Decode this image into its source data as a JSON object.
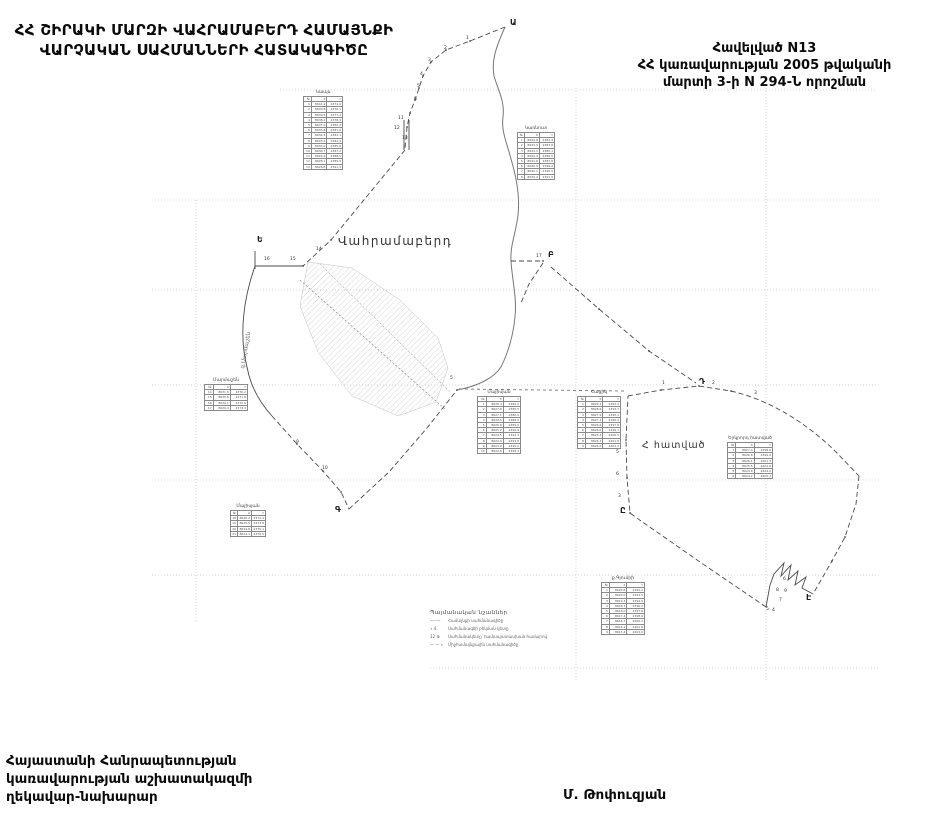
{
  "header": {
    "title_line1": "ՀՀ ՇԻՐԱԿԻ ՄԱՐԶԻ ՎԱՀՐԱՄԱԲԵՐԴ ՀԱՄԱՅՆՔԻ",
    "title_line2": "ՎԱՐՉԱԿԱՆ ՍԱՀՄԱՆՆԵՐԻ ՀԱՏԱԿԱԳԻԾԸ"
  },
  "appendix": {
    "line1": "Հավելված  N13",
    "line2": "ՀՀ կառավարության 2005 թվականի",
    "line3": "մարտի 3-ի N 294-Ն որոշման"
  },
  "footer": {
    "left_line1": "Հայաստանի Հանրապետության",
    "left_line2": "կառավարության աշխատակազմի",
    "left_line3": "ղեկավար-նախարար",
    "signature": "Մ. Թոփուզյան"
  },
  "map": {
    "settlement_label": "Վահրամաբերդ",
    "section_label": "Հ հատված",
    "west_label": "գ.Մարմաշեն",
    "colors": {
      "boundary": "#4a4a4a",
      "river": "#777777",
      "grid": "#cccccc",
      "hatch": "#b5b5b5"
    },
    "letters": [
      {
        "t": "Ա",
        "x": 510,
        "y": 18
      },
      {
        "t": "Բ",
        "x": 548,
        "y": 250
      },
      {
        "t": "Գ",
        "x": 335,
        "y": 505
      },
      {
        "t": "Դ",
        "x": 699,
        "y": 377
      },
      {
        "t": "Ե",
        "x": 257,
        "y": 235
      },
      {
        "t": "Ը",
        "x": 620,
        "y": 506
      },
      {
        "t": "Է",
        "x": 806,
        "y": 593
      }
    ],
    "points": [
      {
        "t": "1",
        "x": 466,
        "y": 36
      },
      {
        "t": "2",
        "x": 444,
        "y": 46
      },
      {
        "t": "3",
        "x": 428,
        "y": 58
      },
      {
        "t": "4",
        "x": 420,
        "y": 72
      },
      {
        "t": "5",
        "x": 417,
        "y": 84
      },
      {
        "t": "6",
        "x": 414,
        "y": 97
      },
      {
        "t": "11",
        "x": 398,
        "y": 116
      },
      {
        "t": "12",
        "x": 394,
        "y": 126
      },
      {
        "t": "13",
        "x": 402,
        "y": 136
      },
      {
        "t": "14",
        "x": 316,
        "y": 247
      },
      {
        "t": "15",
        "x": 290,
        "y": 257
      },
      {
        "t": "16",
        "x": 264,
        "y": 257
      },
      {
        "t": "17",
        "x": 536,
        "y": 254
      },
      {
        "t": "9",
        "x": 296,
        "y": 440
      },
      {
        "t": "10",
        "x": 322,
        "y": 466
      },
      {
        "t": "5",
        "x": 450,
        "y": 376
      },
      {
        "t": "1",
        "x": 662,
        "y": 381
      },
      {
        "t": "2",
        "x": 712,
        "y": 381
      },
      {
        "t": "3",
        "x": 754,
        "y": 391
      },
      {
        "t": "4",
        "x": 616,
        "y": 430
      },
      {
        "t": "5",
        "x": 616,
        "y": 450
      },
      {
        "t": "6",
        "x": 616,
        "y": 472
      },
      {
        "t": "3",
        "x": 618,
        "y": 494
      },
      {
        "t": "6",
        "x": 783,
        "y": 577
      },
      {
        "t": "8",
        "x": 776,
        "y": 588
      },
      {
        "t": "9",
        "x": 784,
        "y": 589
      },
      {
        "t": "7",
        "x": 779,
        "y": 598
      },
      {
        "t": "4",
        "x": 772,
        "y": 608
      },
      {
        "t": "5",
        "x": 766,
        "y": 607
      }
    ],
    "table_header": [
      "№",
      "X",
      "Y"
    ],
    "tables": [
      {
        "title": "Կապս",
        "x": 303,
        "y": 90,
        "w": 40,
        "rows": [
          [
            "1",
            "8641.2",
            "2374.6"
          ],
          [
            "2",
            "8640.8",
            "2376.1"
          ],
          [
            "3",
            "8639.5",
            "2377.4"
          ],
          [
            "4",
            "8638.2",
            "2378.9"
          ],
          [
            "5",
            "8637.0",
            "2380.2"
          ],
          [
            "6",
            "8635.8",
            "2381.6"
          ],
          [
            "7",
            "8634.5",
            "2383.1"
          ],
          [
            "8",
            "8633.2",
            "2384.4"
          ],
          [
            "9",
            "8632.0",
            "2385.8"
          ],
          [
            "10",
            "8630.7",
            "2387.2"
          ],
          [
            "11",
            "8629.4",
            "2388.5"
          ],
          [
            "12",
            "8628.1",
            "2389.9"
          ],
          [
            "13",
            "8626.8",
            "2391.3"
          ]
        ]
      },
      {
        "title": "Կառնուտ",
        "x": 517,
        "y": 126,
        "w": 38,
        "rows": [
          [
            "1",
            "8644.6",
            "2382.4"
          ],
          [
            "2",
            "8643.9",
            "2383.8"
          ],
          [
            "3",
            "8643.1",
            "2385.1"
          ],
          [
            "4",
            "8642.4",
            "2386.5"
          ],
          [
            "5",
            "8641.6",
            "2387.8"
          ],
          [
            "6",
            "8640.9",
            "2389.2"
          ],
          [
            "7",
            "8640.1",
            "2390.5"
          ],
          [
            "8",
            "8639.4",
            "2391.9"
          ]
        ]
      },
      {
        "title": "Մարմաշեն",
        "x": 204,
        "y": 378,
        "w": 44,
        "rows": [
          [
            "14",
            "8631.5",
            "2370.2"
          ],
          [
            "15",
            "8630.8",
            "2371.6"
          ],
          [
            "16",
            "8630.1",
            "2372.9"
          ],
          [
            "17",
            "8629.4",
            "2374.3"
          ]
        ]
      },
      {
        "title": "Մայիսյան",
        "x": 230,
        "y": 504,
        "w": 36,
        "rows": [
          [
            "18",
            "8626.2",
            "2372.4"
          ],
          [
            "19",
            "8625.5",
            "2373.8"
          ],
          [
            "20",
            "8624.8",
            "2375.1"
          ],
          [
            "21",
            "8624.1",
            "2376.5"
          ]
        ]
      },
      {
        "title": "Մայիսյան",
        "x": 477,
        "y": 390,
        "w": 44,
        "rows": [
          [
            "1",
            "8628.4",
            "2384.2"
          ],
          [
            "2",
            "8627.8",
            "2385.5"
          ],
          [
            "3",
            "8627.1",
            "2386.9"
          ],
          [
            "4",
            "8626.5",
            "2388.2"
          ],
          [
            "5",
            "8625.8",
            "2389.6"
          ],
          [
            "6",
            "8625.2",
            "2390.9"
          ],
          [
            "7",
            "8624.5",
            "2392.3"
          ],
          [
            "8",
            "8623.9",
            "2393.6"
          ],
          [
            "9",
            "8623.2",
            "2395.0"
          ],
          [
            "10",
            "8622.6",
            "2396.3"
          ]
        ]
      },
      {
        "title": "Հացիկ",
        "x": 577,
        "y": 390,
        "w": 44,
        "rows": [
          [
            "1",
            "8629.2",
            "2392.4"
          ],
          [
            "2",
            "8628.6",
            "2393.7"
          ],
          [
            "3",
            "8627.9",
            "2395.1"
          ],
          [
            "4",
            "8627.3",
            "2396.4"
          ],
          [
            "5",
            "8626.6",
            "2397.8"
          ],
          [
            "6",
            "8626.0",
            "2399.1"
          ],
          [
            "7",
            "8625.3",
            "2400.5"
          ],
          [
            "8",
            "8624.7",
            "2401.8"
          ],
          [
            "9",
            "8624.0",
            "2403.2"
          ]
        ]
      },
      {
        "title": "Երկրորդ հատված",
        "x": 727,
        "y": 436,
        "w": 46,
        "rows": [
          [
            "1",
            "8627.4",
            "2398.6"
          ],
          [
            "2",
            "8626.8",
            "2399.9"
          ],
          [
            "3",
            "8626.1",
            "2401.3"
          ],
          [
            "4",
            "8625.5",
            "2402.6"
          ],
          [
            "5",
            "8624.8",
            "2404.0"
          ],
          [
            "6",
            "8624.2",
            "2405.3"
          ]
        ]
      },
      {
        "title": "ք.Գյումրի",
        "x": 601,
        "y": 576,
        "w": 44,
        "rows": [
          [
            "1",
            "8620.6",
            "2392.2"
          ],
          [
            "2",
            "8620.0",
            "2393.5"
          ],
          [
            "3",
            "8619.3",
            "2394.9"
          ],
          [
            "4",
            "8618.7",
            "2396.2"
          ],
          [
            "5",
            "8618.0",
            "2397.6"
          ],
          [
            "6",
            "8617.4",
            "2398.9"
          ],
          [
            "7",
            "8616.7",
            "2400.3"
          ],
          [
            "8",
            "8616.1",
            "2401.6"
          ],
          [
            "9",
            "8615.4",
            "2403.0"
          ]
        ]
      }
    ],
    "legend": {
      "title": "Պայմանական նշաններ",
      "items": [
        {
          "sym": "—··—",
          "label": "Համայնքի սահմանագիծը"
        },
        {
          "sym": "∙ 4",
          "label": "Սահմանագծի բեկման կետը"
        },
        {
          "sym": "12 ⊕",
          "label": "Սահմանակետը՝ համապատասխան համարով"
        },
        {
          "sym": "— — ∙",
          "label": "Միջհամայնքային սահմանագիծը"
        }
      ]
    }
  }
}
